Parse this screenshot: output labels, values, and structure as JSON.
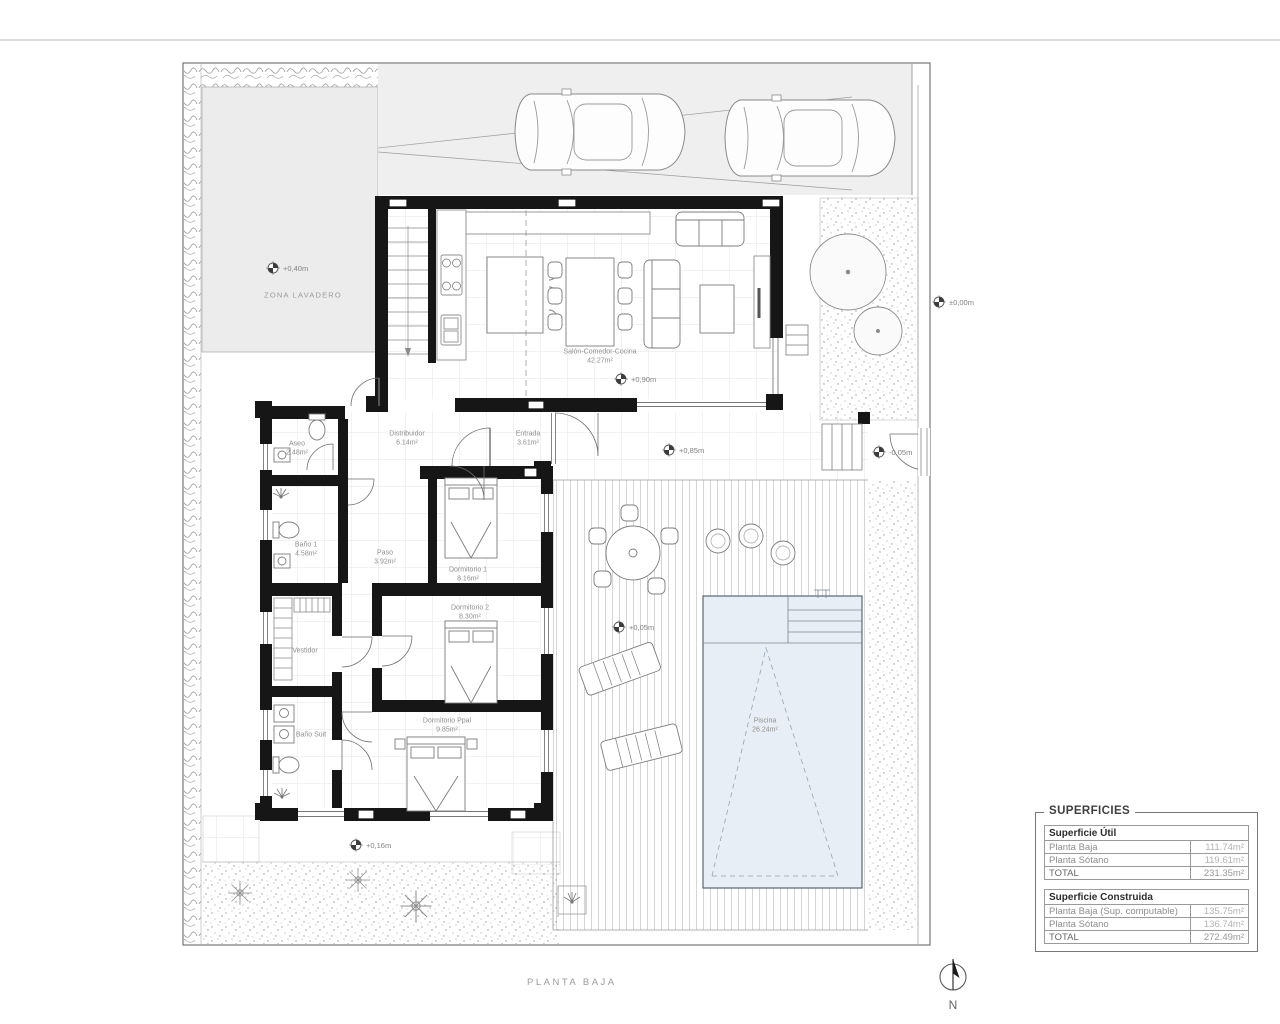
{
  "title": "PLANTA BAJA",
  "north": {
    "label": "N"
  },
  "zones": {
    "zona_lavadero": "ZONA LAVADERO"
  },
  "rooms": {
    "salon": {
      "name": "Salón-Comedor-Cocina",
      "area": "42.27m²"
    },
    "distribuidor": {
      "name": "Distribuidor",
      "area": "6.14m²"
    },
    "entrada": {
      "name": "Entrada",
      "area": "3.61m²"
    },
    "aseo": {
      "name": "Aseo",
      "area": "2.48m²"
    },
    "bano1": {
      "name": "Baño 1",
      "area": "4.58m²"
    },
    "paso": {
      "name": "Paso",
      "area": "3.92m²"
    },
    "dormitorio1": {
      "name": "Dormitorio 1",
      "area": "8.16m²"
    },
    "dormitorio2": {
      "name": "Dormitorio 2",
      "area": "8.30m²"
    },
    "vestidor": {
      "name": "Vestidor"
    },
    "bano_suit": {
      "name": "Baño Suit"
    },
    "dormitorio_ppal": {
      "name": "Dormitorio Ppal",
      "area": "9.85m²"
    },
    "piscina": {
      "name": "Piscina",
      "area": "26.24m²"
    }
  },
  "elevations": {
    "laundry": "+0,40m",
    "living": "+0,90m",
    "porch": "+0,85m",
    "entry_step": "-0,05m",
    "plot_right": "±0,00m",
    "terrace": "+0,05m",
    "south": "+0,16m"
  },
  "superficies": {
    "title": "SUPERFICIES",
    "util": {
      "title": "Superficie Útil",
      "rows": [
        {
          "label": "Planta Baja",
          "value": "111.74m²"
        },
        {
          "label": "Planta Sótano",
          "value": "119.61m²"
        },
        {
          "label": "TOTAL",
          "value": "231.35m²"
        }
      ]
    },
    "construida": {
      "title": "Superficie Construida",
      "rows": [
        {
          "label": "Planta Baja (Sup. computable)",
          "value": "135.75m²"
        },
        {
          "label": "Planta Sótano",
          "value": "136.74m²"
        },
        {
          "label": "TOTAL",
          "value": "272.49m²"
        }
      ]
    }
  }
}
